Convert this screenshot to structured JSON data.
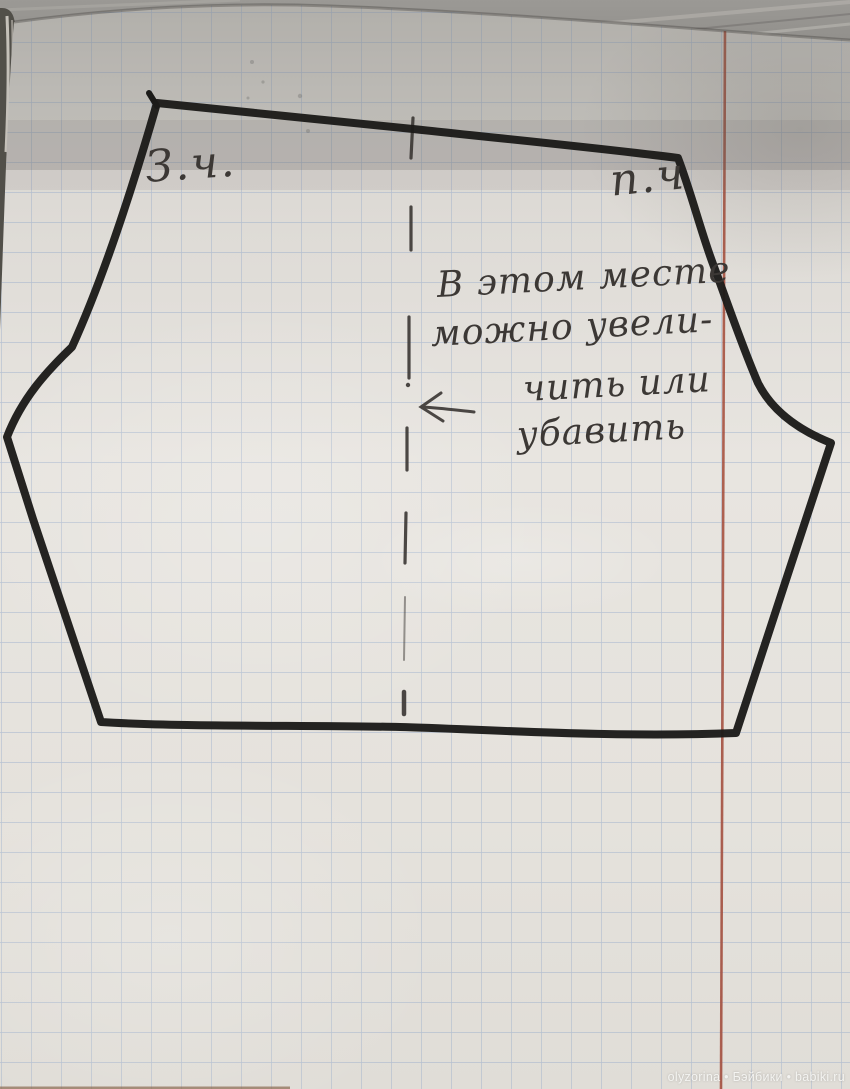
{
  "labels": {
    "back_piece": "З.ч.",
    "front_piece": "п.ч"
  },
  "annotation": {
    "lines": [
      "В этом месте",
      "можно увели-",
      "чить или",
      "убавить"
    ]
  },
  "watermark": {
    "text": "olyzorina • Бэйбики • babiki.ru"
  },
  "colors": {
    "paper": "#e7e4df",
    "paper_shadow": "#cbc8c3",
    "grid_blue": "#8aa2c8",
    "margin_red": "#a34a38",
    "ink_black": "#1c1b19",
    "pencil_gray": "#3a3633",
    "wood_gray": "#908e8a",
    "wood_streak": "#bab7b2",
    "notebook_edge_dark": "#514f49",
    "page_stack_light": "#d8d4cd",
    "watermark_white": "#f2f1ef"
  }
}
